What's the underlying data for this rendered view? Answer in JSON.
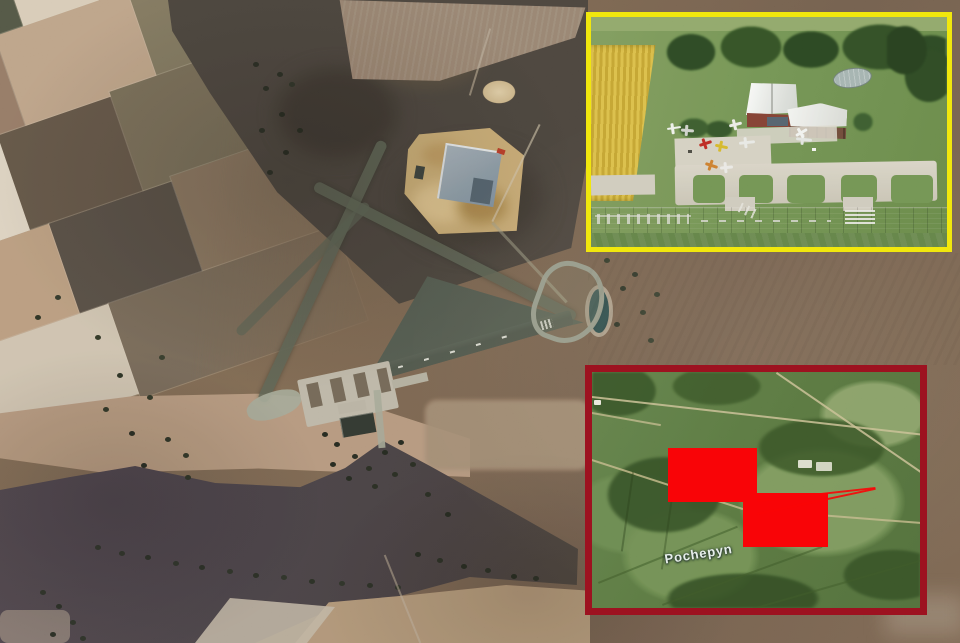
{
  "map_inset": {
    "place_label": "Pochepyn"
  },
  "palette": {
    "photo_inset_border": "#f1e70d",
    "map_inset_border": "#9d1220",
    "redaction_red": "#f90306",
    "map_label_color": "#e4ede9",
    "runway_gray": "#4d554b",
    "field_brown": "#6f5d4a",
    "burnt_field": "#46413b",
    "inset_map_green": "#56713f"
  }
}
